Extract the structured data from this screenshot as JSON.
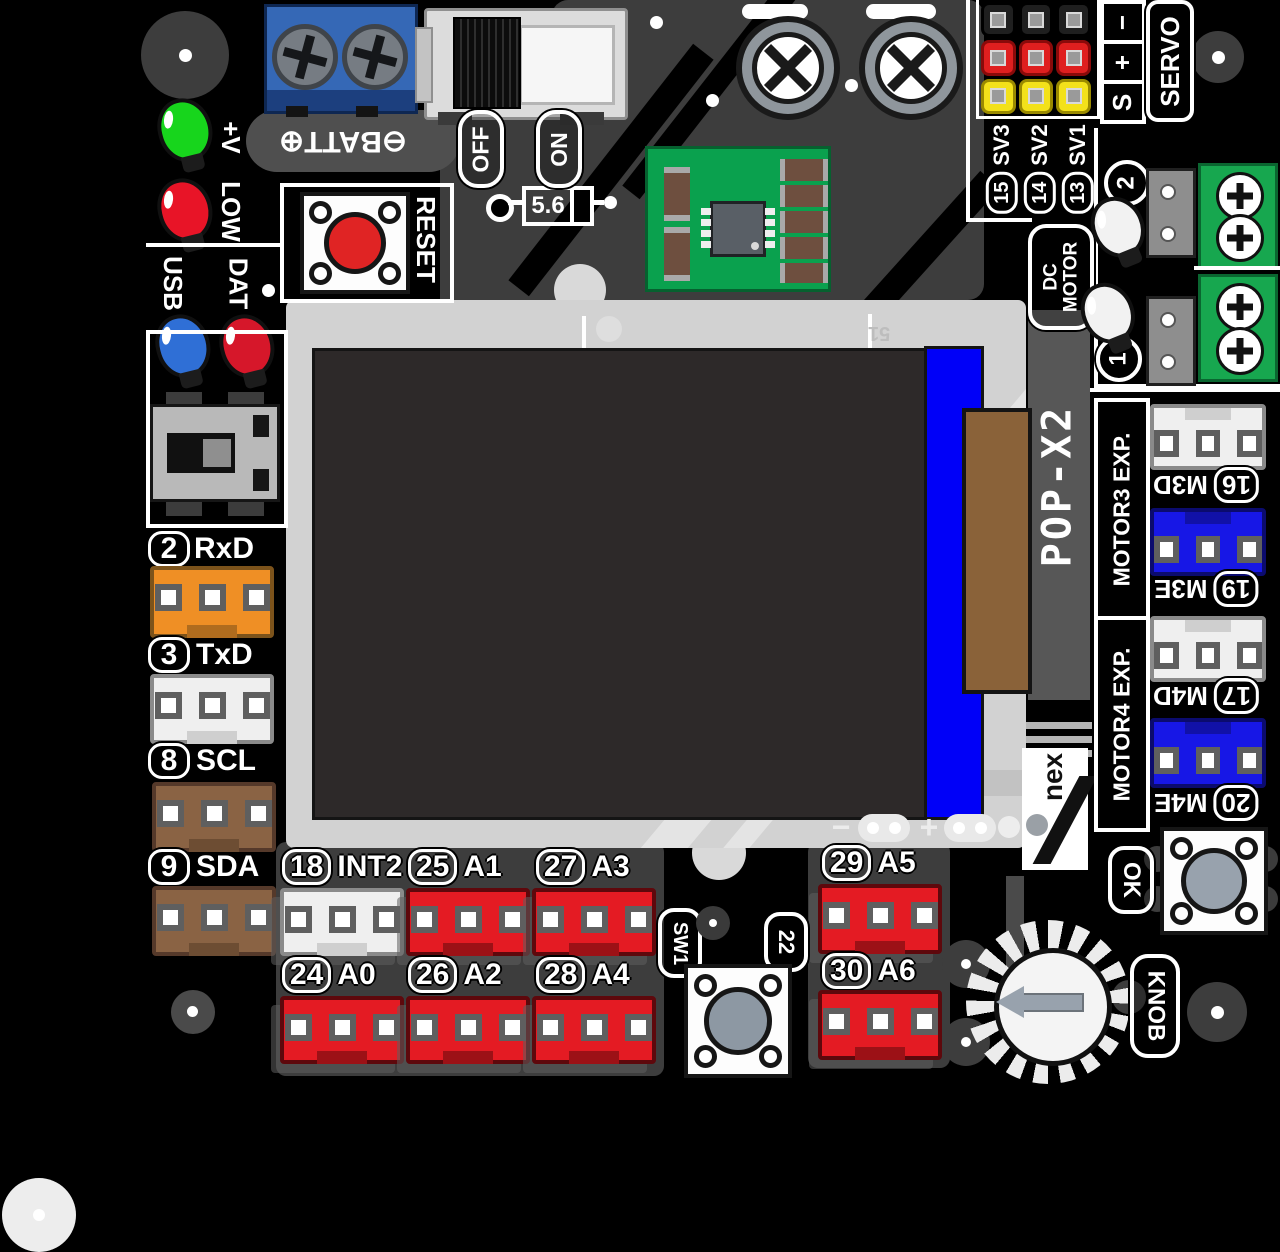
{
  "board_name": "POP-X2",
  "brand": "nex",
  "power": {
    "batt_label": "⊖BATT⊕",
    "off": "OFF",
    "on": "ON",
    "diode_value": "5.6",
    "reset": "RESET",
    "led_power": "+V",
    "led_low": "LOW"
  },
  "status_leds": {
    "usb": "USB",
    "dat": "DAT"
  },
  "servo": {
    "title": "SERVO",
    "pin_rows": [
      "−",
      "+",
      "S"
    ],
    "channels": [
      {
        "num": "15",
        "name": "SV3"
      },
      {
        "num": "14",
        "name": "SV2"
      },
      {
        "num": "13",
        "name": "SV1"
      }
    ]
  },
  "dc_motor": {
    "line1": "DC",
    "line2": "MOTOR",
    "outputs": [
      {
        "num": "2"
      },
      {
        "num": "1"
      }
    ]
  },
  "motor_exp": [
    {
      "title": "MOTOR3 EXP.",
      "ports": [
        {
          "num": "16",
          "name": "M3D"
        },
        {
          "num": "19",
          "name": "M3E"
        }
      ]
    },
    {
      "title": "MOTOR4 EXP.",
      "ports": [
        {
          "num": "17",
          "name": "M4D"
        },
        {
          "num": "20",
          "name": "M4E"
        }
      ]
    }
  ],
  "left_ports": [
    {
      "num": "2",
      "name": "RxD"
    },
    {
      "num": "3",
      "name": "TxD"
    },
    {
      "num": "8",
      "name": "SCL"
    },
    {
      "num": "9",
      "name": "SDA"
    }
  ],
  "bottom_ports": [
    {
      "num": "18",
      "name": "INT2"
    },
    {
      "num": "25",
      "name": "A1"
    },
    {
      "num": "27",
      "name": "A3"
    },
    {
      "num": "29",
      "name": "A5"
    },
    {
      "num": "24",
      "name": "A0"
    },
    {
      "num": "26",
      "name": "A2"
    },
    {
      "num": "28",
      "name": "A4"
    },
    {
      "num": "30",
      "name": "A6"
    }
  ],
  "switches": {
    "sw1": "SW1",
    "sw1_pin": "22",
    "ok": "OK",
    "knob": "KNOB"
  },
  "screen": {
    "mark": "51",
    "minus": "−",
    "plus": "+"
  },
  "colors": {
    "board": "#000000",
    "ground_plane": "#3d3d3d",
    "silkscreen": "#ffffff",
    "port_red": "#e41b23",
    "port_orange": "#ef8f25",
    "port_brown": "#8a6344",
    "port_blue": "#1717e6",
    "terminal_green": "#17a74f",
    "terminal_blue": "#3063b2",
    "lcd_frame": "#d2d2d2",
    "lcd_panel": "#2d2929",
    "lcd_strip": "#0000f8",
    "flex_brown": "#8a6239"
  }
}
